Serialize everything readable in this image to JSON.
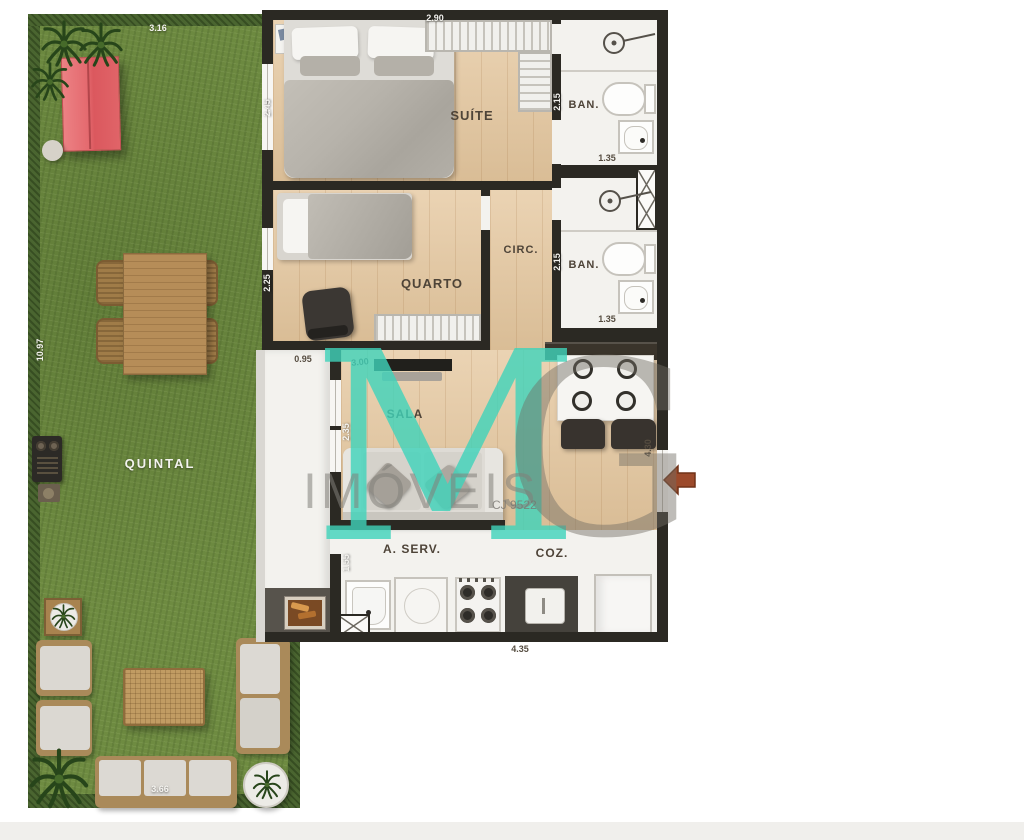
{
  "plan": {
    "rooms": {
      "quintal": "QUINTAL",
      "suite": "SUÍTE",
      "quarto": "QUARTO",
      "circ": "CIRC.",
      "ban1": "BAN.",
      "ban2": "BAN.",
      "sala": "SALA",
      "aserv": "A. SERV.",
      "coz": "COZ."
    },
    "dimensions": {
      "yard_top": "3.16",
      "yard_left": "10.97",
      "yard_bottom": "3.66",
      "suite_width": "2.90",
      "suite_depth": "2.45",
      "ban1_depth": "2.15",
      "ban1_width": "1.35",
      "ban2_depth": "2.15",
      "ban2_width": "1.35",
      "quarto_depth": "2.25",
      "corridor_width": "0.95",
      "sala_width": "3.00",
      "sala_depth": "2.35",
      "kitchen_depth": "4.30",
      "aserv_depth": "1.55",
      "kitchen_width": "4.35"
    }
  },
  "watermark": {
    "monogram_m": "M",
    "monogram_g": "G",
    "brand": "IMÓVEIS",
    "license": "CJ 9522",
    "teal": "#3fd4bb",
    "gray": "#8b887f"
  },
  "colors": {
    "grass": "#6e8b41",
    "hedge": "#4a6530",
    "wall": "#2b2923",
    "wood_floor": "#e5c79e",
    "white_floor": "#f3f2ee",
    "shed_red": "#e26167",
    "entry_arrow": "#9c4a2b"
  }
}
